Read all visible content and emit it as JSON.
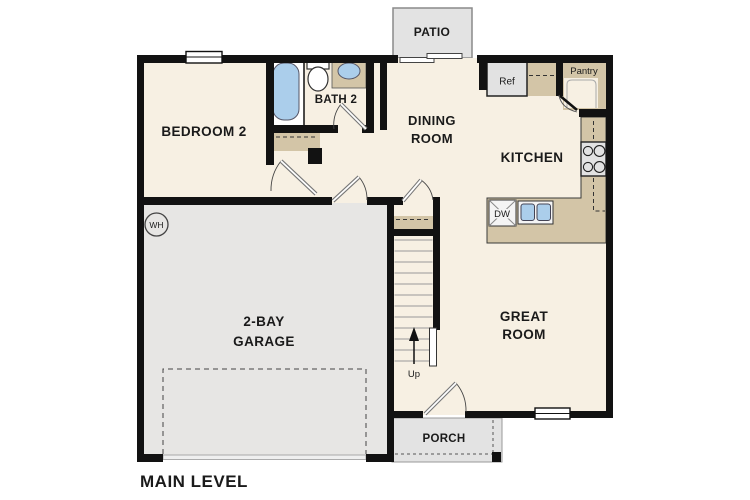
{
  "plan": {
    "level_label": "MAIN LEVEL",
    "rooms": {
      "bedroom2": "BEDROOM 2",
      "bath2": "BATH 2",
      "dining": [
        "DINING",
        "ROOM"
      ],
      "kitchen": "KITCHEN",
      "great_room": [
        "GREAT",
        "ROOM"
      ],
      "garage": [
        "2-BAY",
        "GARAGE"
      ],
      "pantry": "Pantry",
      "patio": "PATIO",
      "porch": "PORCH"
    },
    "labels": {
      "refrigerator": "Ref",
      "dishwasher": "DW",
      "water_heater": "WH",
      "stairs_up": "Up"
    },
    "colors": {
      "floor": "#f7f0e3",
      "counter_tan": "#d3c5a7",
      "garage_gray": "#e7e6e4",
      "outdoor_gray": "#e3e3e3",
      "appliance_gray": "#e2e2e2",
      "fixture_blue": "#abceeb",
      "wall": "#121212",
      "white": "#ffffff"
    }
  }
}
